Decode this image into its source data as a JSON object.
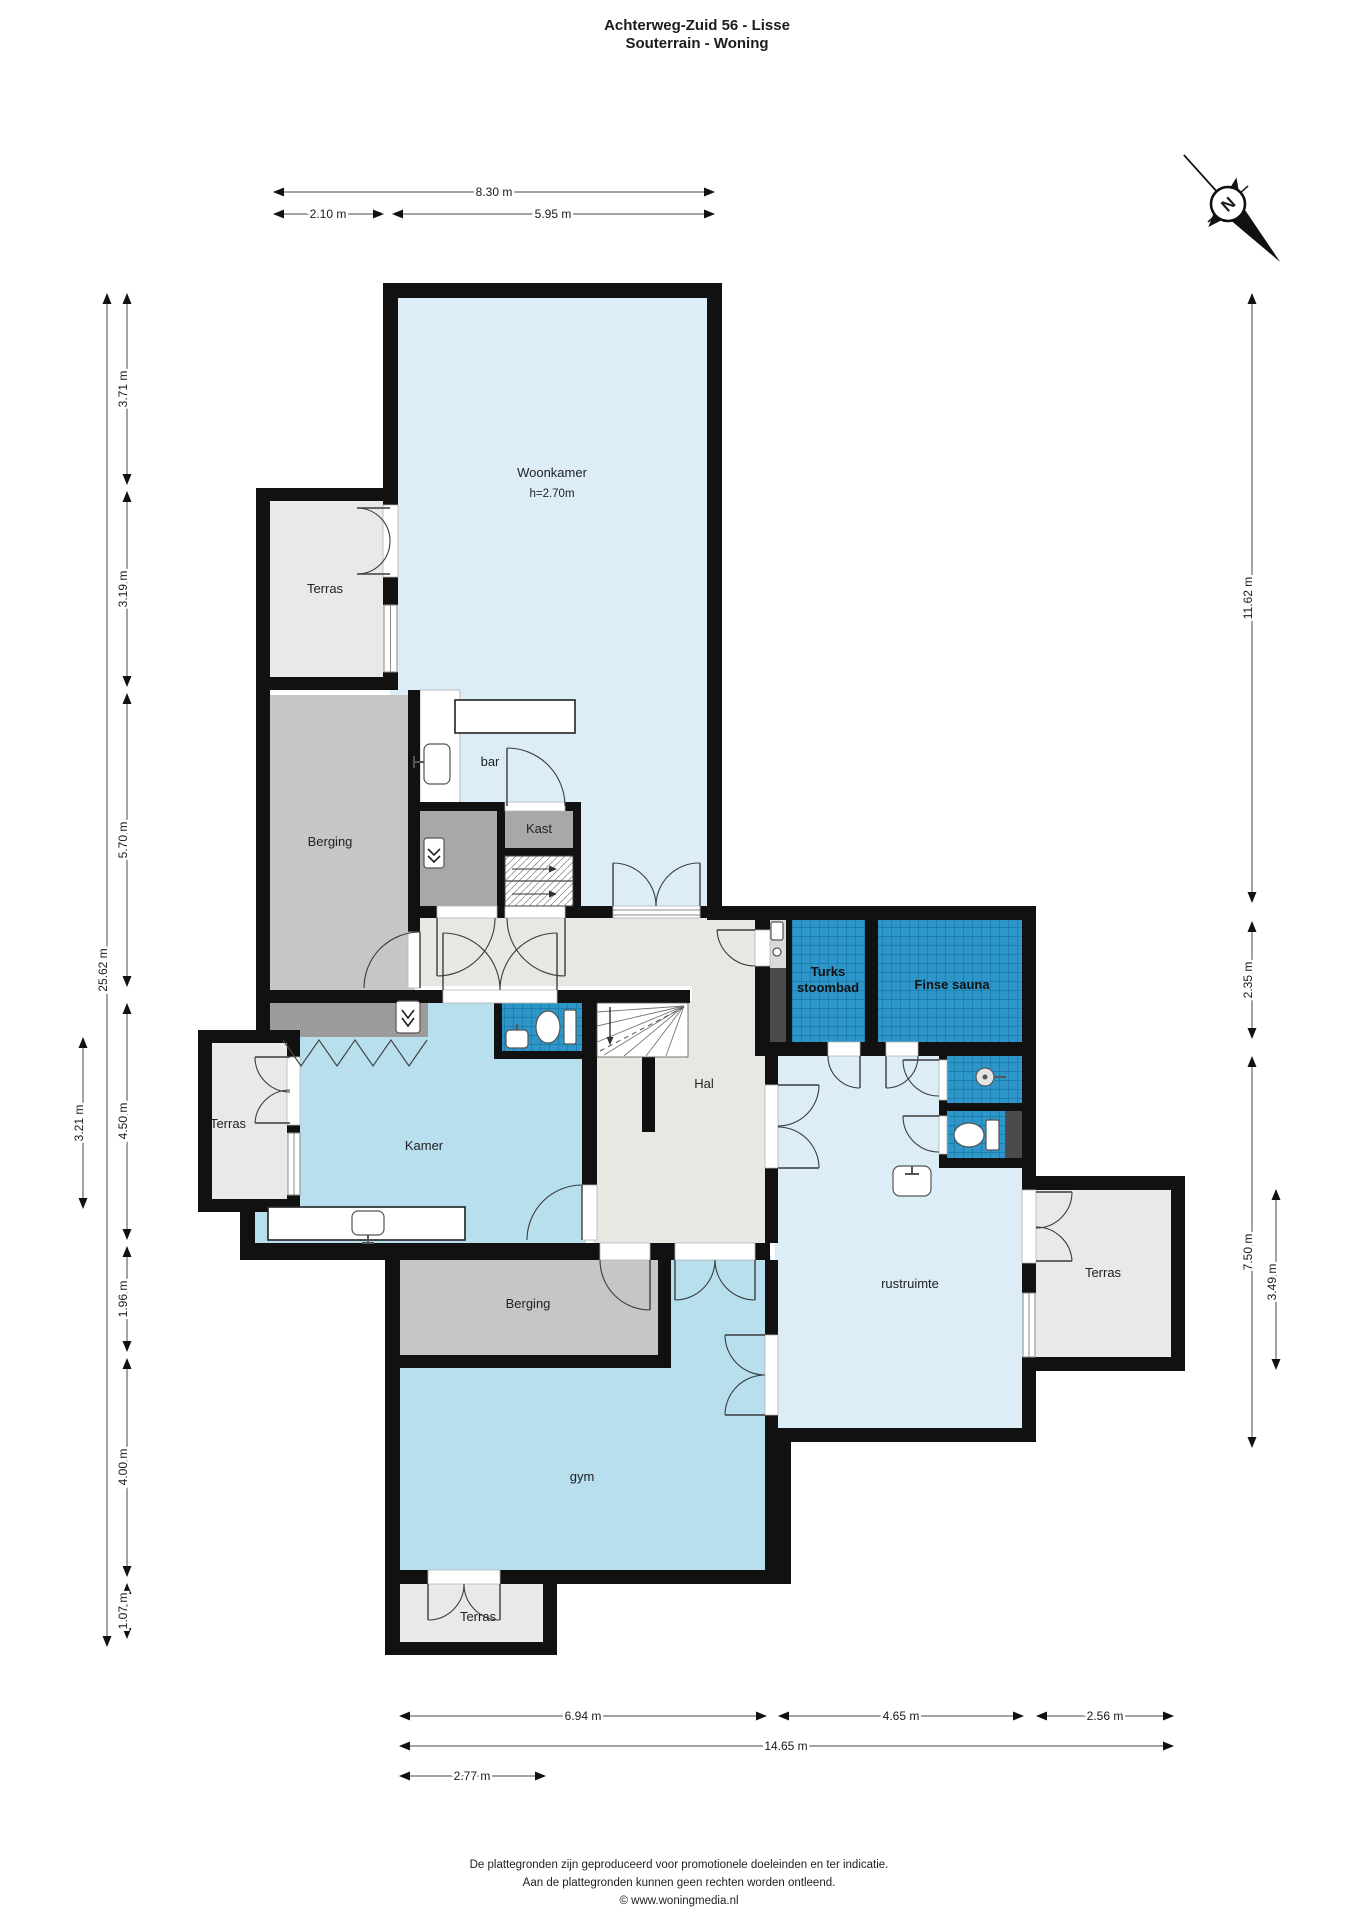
{
  "title": {
    "line1": "Achterweg-Zuid 56 - Lisse",
    "line2": "Souterrain - Woning"
  },
  "compass": {
    "label": "N"
  },
  "rooms": {
    "woonkamer": {
      "label": "Woonkamer",
      "ceiling_height": "h=2.70m"
    },
    "terras_top": {
      "label": "Terras"
    },
    "berging_top": {
      "label": "Berging"
    },
    "bar": {
      "label": "bar"
    },
    "kast": {
      "label": "Kast"
    },
    "hal": {
      "label": "Hal"
    },
    "kamer": {
      "label": "Kamer"
    },
    "terras_left": {
      "label": "Terras"
    },
    "turks": {
      "line1": "Turks",
      "line2": "stoombad"
    },
    "finse": {
      "label": "Finse sauna"
    },
    "rustruimte": {
      "label": "rustruimte"
    },
    "terras_right": {
      "label": "Terras"
    },
    "berging_low": {
      "label": "Berging"
    },
    "gym": {
      "label": "gym"
    },
    "terras_bottom": {
      "label": "Terras"
    }
  },
  "dimensions": {
    "top": [
      {
        "v": "8.30 m"
      },
      {
        "v": "2.10 m"
      },
      {
        "v": "5.95 m"
      }
    ],
    "left": [
      {
        "v": "3.71 m"
      },
      {
        "v": "3.19 m"
      },
      {
        "v": "5.70 m"
      },
      {
        "v": "4.50 m"
      },
      {
        "v": "1.96 m"
      },
      {
        "v": "4.00 m"
      },
      {
        "v": "1.07 m"
      },
      {
        "v": "25.62 m"
      },
      {
        "v": "3.21 m"
      }
    ],
    "right": [
      {
        "v": "11.62 m"
      },
      {
        "v": "2.35 m"
      },
      {
        "v": "7.50 m"
      },
      {
        "v": "3.49 m"
      }
    ],
    "bottom": [
      {
        "v": "6.94 m"
      },
      {
        "v": "4.65 m"
      },
      {
        "v": "2.56 m"
      },
      {
        "v": "14.65 m"
      },
      {
        "v": "2.77 m"
      }
    ]
  },
  "footer": {
    "line1": "De plattegronden zijn geproduceerd voor promotionele doeleinden en ter indicatie.",
    "line2": "Aan de plattegronden kunnen geen rechten worden ontleend.",
    "line3": "© www.woningmedia.nl"
  },
  "colors": {
    "wall": "#111111",
    "room_blue_light": "#dcedf7",
    "room_blue_mid": "#b7dfee",
    "terras_gray": "#e9e9e9",
    "berging_gray": "#c6c6c6",
    "closet_gray": "#a8a8a8",
    "wardrobe_gray": "#9c9c9c",
    "hal_gray": "#e8e7e2",
    "tile_blue": "#2e96c8",
    "tile_grid": "#1173a2",
    "dark_niche": "#4b4b4b"
  }
}
